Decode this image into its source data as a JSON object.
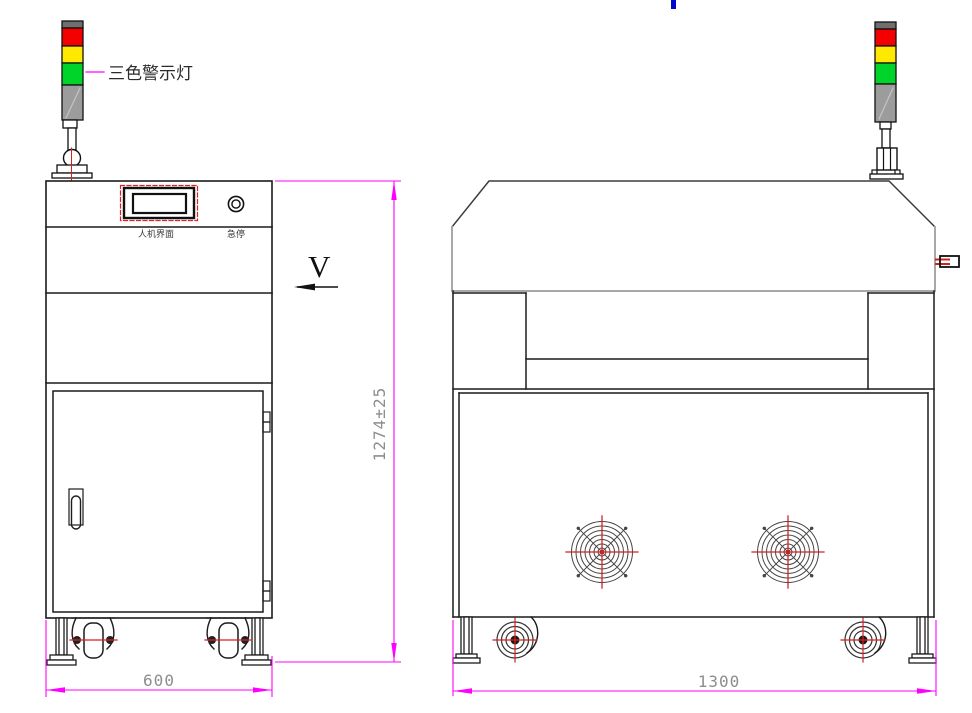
{
  "drawing": {
    "type": "engineering-2-view-drawing",
    "subject": "machine with tri-color signal tower, HMI panel, fans and casters",
    "labels": {
      "tower": "三色警示灯",
      "hmi": "人机界面",
      "estop": "急停",
      "view": "V"
    },
    "dimensions": {
      "overall_height": "1274±25",
      "side_width": "600",
      "front_width": "1300"
    },
    "colors": {
      "dimension_magenta": "#ff00ff",
      "outline_black": "#1c1c1c",
      "hood_gray": "#a8a8a8",
      "dim_text_gray": "#8d8d8d",
      "tower_red": "#f40000",
      "tower_yellow": "#ffe900",
      "tower_green": "#00d42a",
      "tower_body_gray": "#9c9c9c",
      "centerline_red": "#d42222",
      "top_blue_mark": "#0009c8"
    }
  }
}
